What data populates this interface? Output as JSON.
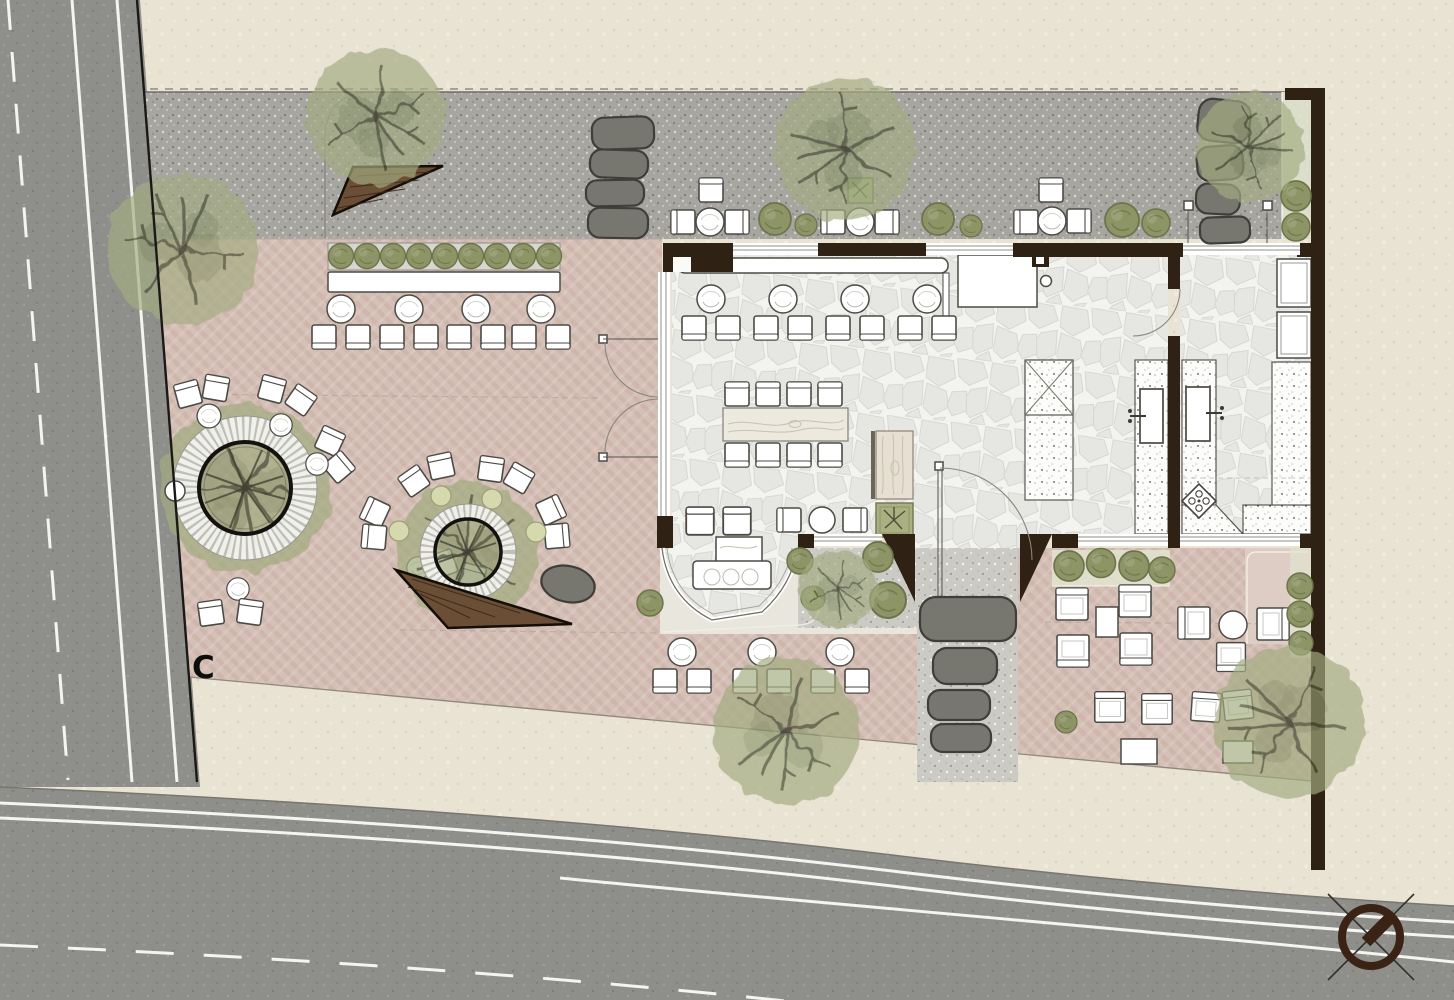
{
  "plan": {
    "section_marker_label": "C"
  },
  "palette": {
    "paper": "#e9e3d4",
    "road": "#8e8e8a",
    "roadline": "#f4f4f0",
    "gravel": "#a6a5a0",
    "gravelL": "#cbcac4",
    "terrace": "#d5c0b7",
    "terraceStripe": "#c6aca1",
    "terraceStripeLight": "#e3d3cb",
    "wall": "#2f2113",
    "wood": "#6a4e36",
    "woodD": "#3a2a18",
    "floorJoint": "#f3f3f0",
    "floorStone": "#e6e6e3",
    "counter": "#fcfcfa",
    "line": "#4c4a45",
    "canopy": "#a3ac81",
    "canopyD": "#7c865e",
    "branch": "#41462f",
    "shrub": "#8d9465",
    "shrubD": "#6d744b",
    "boulder": "#85847e",
    "stoneD": "#77766f",
    "greenBed": "#e2e4d0",
    "north": "#3a2314",
    "marker": "#0d0d0b"
  }
}
